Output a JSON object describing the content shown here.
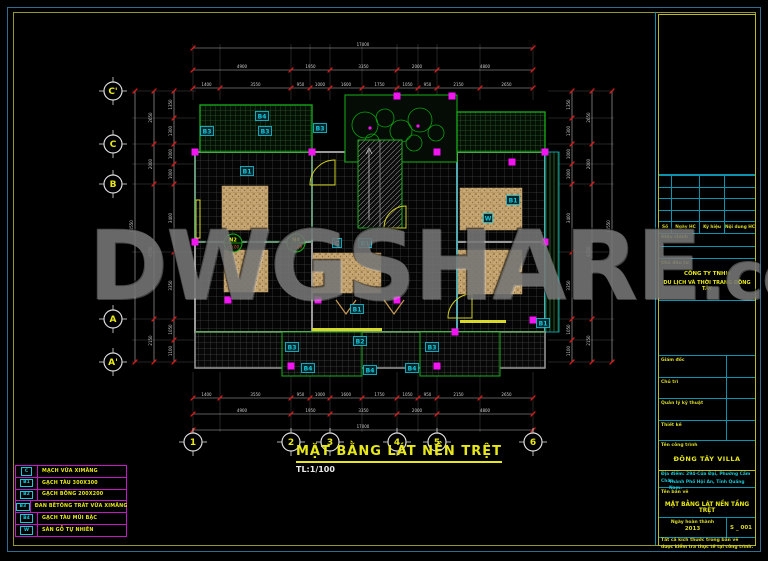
{
  "watermark": {
    "text": "DWGSHARE",
    "suffix": ".com"
  },
  "drawing_title": {
    "text": "MẶT BẰNG LÁT NỀN TRỆT",
    "scale": "TL:1/100"
  },
  "grid": {
    "columns": [
      "1",
      "2",
      "3",
      "4",
      "5",
      "6"
    ],
    "rows": [
      "C'",
      "C",
      "B",
      "A",
      "A'"
    ]
  },
  "legend": {
    "rows": [
      {
        "code": "C",
        "label": "MẠCH VỮA XIMĂNG"
      },
      {
        "code": "B1",
        "label": "GẠCH TÀU 300X300"
      },
      {
        "code": "B2",
        "label": "GẠCH BÔNG 200X200"
      },
      {
        "code": "B3",
        "label": "ĐAN BÊTÔNG TRÁT VỮA XIMĂNG"
      },
      {
        "code": "B4",
        "label": "GẠCH TÀU MŨI BẬC"
      },
      {
        "code": "W",
        "label": "SÀN GỖ TỰ NHIÊN"
      }
    ]
  },
  "plan": {
    "room_labels": [
      "B4",
      "B3",
      "B3",
      "B3",
      "B1",
      "C",
      "B1",
      "B1",
      "B1",
      "B2",
      "B3",
      "B3",
      "B4",
      "B4",
      "B4",
      "B1",
      "W"
    ],
    "level_markers": [
      {
        "name": "N2",
        "level": "±0.00"
      },
      {
        "name": "N4",
        "level": "±0.00"
      }
    ],
    "dims": {
      "h_total": [
        "17000"
      ],
      "h_major": [
        "4900",
        "1950",
        "3350",
        "2000",
        "4800"
      ],
      "h_minor": [
        "1400",
        "3550",
        "950",
        "1000",
        "1600",
        "1750",
        "1050",
        "950",
        "2150",
        "2650"
      ],
      "v_total": [
        "13550"
      ],
      "v_major": [
        "2650",
        "2000",
        "6750",
        "2150"
      ],
      "v_minor": [
        "1350",
        "1300",
        "1000",
        "1000",
        "3400",
        "3350",
        "1050",
        "1100"
      ]
    }
  },
  "title_block": {
    "revision_header": [
      "Số",
      "Ngày HC",
      "Ký hiệu",
      "Nội dung HC"
    ],
    "revision_label": "Hiệu chỉnh",
    "client_label": "Chủ đầu tư",
    "client_name_1": "CÔNG TY TNHH",
    "client_name_2": "DU LỊCH VÀ THỜI TRANG ĐÔNG TÂY",
    "director_label": "Giám đốc",
    "lead_label": "Chủ trì",
    "qa_label": "Quản lý kỹ thuật",
    "designer_label": "Thiết kế",
    "project_label": "Tên công trình",
    "project_name": "ĐÔNG TÂY VILLA",
    "address_label": "Địa điểm:",
    "address_1": "294-Cửa Đại, Phường Cẩm Châu,",
    "address_2": "Thành Phố Hội An, Tỉnh Quảng Nam.",
    "sheet_label": "Tên bản vẽ",
    "sheet_name": "MẶT BẰNG LÁT NỀN TẦNG TRỆT",
    "date_label": "Ngày hoàn thành",
    "date_value": "2013",
    "sheet_number": "S _ 001",
    "note_1": "Tất cả kích thước trong bản vẽ",
    "note_2": "được kiểm tra thực tế tại công trình."
  },
  "colors": {
    "cad_yellow": "#e8e818",
    "cad_cyan": "#18c9dd",
    "cad_magenta": "#f313f3",
    "cad_red": "#e81818",
    "cad_green": "#18b018",
    "frame_blue": "#2f6e8e",
    "frame_olive": "#96962e",
    "rug_tan": "#c7a774",
    "watermark_gray": "#8a8a8a"
  }
}
